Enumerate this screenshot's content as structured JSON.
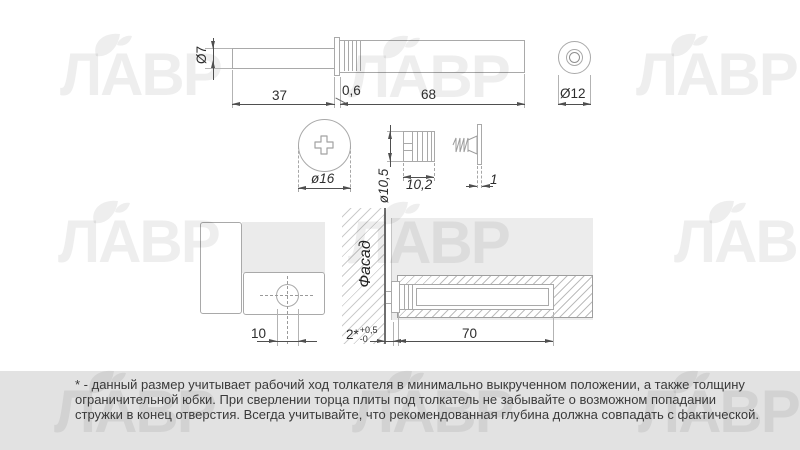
{
  "watermark": {
    "text": "ЛАВР"
  },
  "colors": {
    "outline": "#a9a9a9",
    "dimension": "#4f4f4f",
    "panel_gray": "#ececec",
    "band_gray": "#e2e2e2",
    "hatch_gray": "#c9c9c9",
    "facade_line": "#6f6f6f",
    "watermark": "rgba(0,0,0,0.068)"
  },
  "top_view": {
    "rod_diameter": "Ø7",
    "rod_length": "37",
    "flange_thickness": "0,6",
    "body_length": "68",
    "end_diameter": "Ø12"
  },
  "mid_view": {
    "cap_diameter": "ø16",
    "sleeve_diameter": "ø10,5",
    "sleeve_length": "10,2",
    "washer_thickness": "1"
  },
  "bottom_view": {
    "facade_label": "Фасад",
    "hole_diameter": "10",
    "gap_value": "2*",
    "gap_tol_plus": "+0,5",
    "gap_tol_minus": "-0",
    "drill_depth": "70"
  },
  "footnote": {
    "lines": [
      "* - данный размер учитывает рабочий ход толкателя в минимально выкрученном положении, а также толщину",
      "ограничительной юбки. При сверлении торца плиты под толкатель не забывайте о возможном попадании",
      "стружки в конец отверстия. Всегда учитывайте, что рекомендованная глубина должна совпадать с фактической."
    ]
  }
}
